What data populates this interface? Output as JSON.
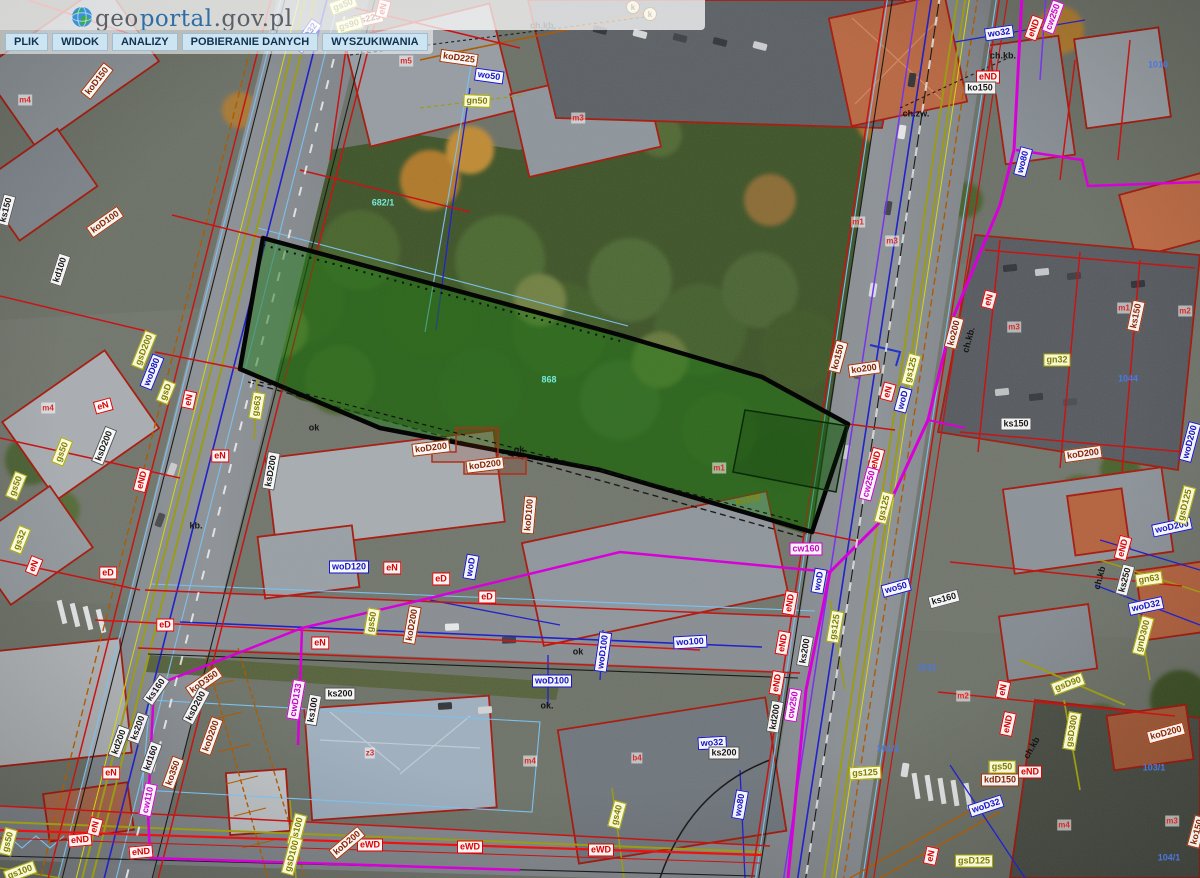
{
  "app": {
    "site": "geoportal.gov.pl"
  },
  "header": {
    "logo": {
      "geo": "geo",
      "portal": "portal",
      "suffix": ".gov.pl"
    },
    "menu": [
      {
        "label": "PLIK"
      },
      {
        "label": "WIDOK"
      },
      {
        "label": "ANALIZY"
      },
      {
        "label": "POBIERANIE DANYCH"
      },
      {
        "label": "WYSZUKIWANIA"
      }
    ]
  },
  "map": {
    "highlighted_parcel": {
      "number": "868",
      "fill": "#1e7a14",
      "outline": "#000000"
    },
    "utility_legend": {
      "ko_kd_sewer_labels": "#8a2500",
      "ks_sewer_labels": "#1a1a1a",
      "wo_water_labels": "#1515cc",
      "gs_gn_gas_labels": "#7e7e00",
      "e_power_labels": "#e00000",
      "cw_heat_labels": "#cc00cc",
      "parcel_lines": "#c81414",
      "telecom_lines": "#b05a00"
    },
    "labels": [
      {
        "s": "gs50",
        "t": "gs",
        "x": 343,
        "y": 5,
        "r": -20
      },
      {
        "s": "ks225",
        "t": "ko",
        "x": 368,
        "y": 19,
        "r": -12
      },
      {
        "s": "gs90",
        "t": "gs",
        "x": 349,
        "y": 25,
        "r": -15
      },
      {
        "s": "eN",
        "t": "e",
        "x": 383,
        "y": 9,
        "r": -75
      },
      {
        "s": "woD32",
        "t": "wo",
        "x": 307,
        "y": 36,
        "r": -55
      },
      {
        "s": "koD150",
        "t": "ko",
        "x": 97,
        "y": 81,
        "r": -52
      },
      {
        "s": "m4",
        "t": "m",
        "x": 25,
        "y": 100,
        "r": 0
      },
      {
        "s": "ks150",
        "t": "ks",
        "x": 6,
        "y": 210,
        "r": -75
      },
      {
        "s": "koD100",
        "t": "ko",
        "x": 105,
        "y": 222,
        "r": -35
      },
      {
        "s": "kd100",
        "t": "ks",
        "x": 60,
        "y": 270,
        "r": -72
      },
      {
        "s": "m5",
        "t": "m",
        "x": 406,
        "y": 61,
        "r": 0
      },
      {
        "s": "koD225",
        "t": "ko",
        "x": 459,
        "y": 58,
        "r": 8
      },
      {
        "s": "wo50",
        "t": "wo",
        "x": 489,
        "y": 76,
        "r": 8
      },
      {
        "s": "gn50",
        "t": "gs",
        "x": 477,
        "y": 101,
        "r": 2
      },
      {
        "s": "ch.kb.",
        "t": "plain",
        "x": 543,
        "y": 26,
        "r": 0
      },
      {
        "s": "m3",
        "t": "m",
        "x": 578,
        "y": 118,
        "r": 0
      },
      {
        "s": "k",
        "t": "kcirc",
        "x": 633,
        "y": 7,
        "r": 0
      },
      {
        "s": "k",
        "t": "kcirc",
        "x": 650,
        "y": 14,
        "r": 0
      },
      {
        "s": "682/1",
        "t": "cyan",
        "x": 383,
        "y": 203,
        "r": 0
      },
      {
        "s": "wo32",
        "t": "wo",
        "x": 999,
        "y": 33,
        "r": -8
      },
      {
        "s": "eND",
        "t": "e",
        "x": 1034,
        "y": 28,
        "r": -70
      },
      {
        "s": "cw250",
        "t": "cw",
        "x": 1053,
        "y": 17,
        "r": -70
      },
      {
        "s": "ch.kb.",
        "t": "plain",
        "x": 1003,
        "y": 56,
        "r": 0
      },
      {
        "s": "eND",
        "t": "e",
        "x": 988,
        "y": 77,
        "r": 0
      },
      {
        "s": "ko150",
        "t": "ks",
        "x": 980,
        "y": 88,
        "r": 0
      },
      {
        "s": "ch.zw.",
        "t": "plain",
        "x": 916,
        "y": 114,
        "r": 0
      },
      {
        "s": "wo80",
        "t": "wo",
        "x": 1023,
        "y": 162,
        "r": -75
      },
      {
        "s": "1010",
        "t": "num",
        "x": 1158,
        "y": 65,
        "r": 0
      },
      {
        "s": "m1",
        "t": "m",
        "x": 858,
        "y": 222,
        "r": 0
      },
      {
        "s": "m3",
        "t": "m",
        "x": 892,
        "y": 241,
        "r": 0
      },
      {
        "s": "m1",
        "t": "m",
        "x": 1124,
        "y": 308,
        "r": 0
      },
      {
        "s": "m2",
        "t": "m",
        "x": 1185,
        "y": 311,
        "r": 0
      },
      {
        "s": "ks150",
        "t": "ko",
        "x": 1136,
        "y": 316,
        "r": -78
      },
      {
        "s": "gsD200",
        "t": "gs",
        "x": 144,
        "y": 350,
        "r": -68
      },
      {
        "s": "woD80",
        "t": "wo",
        "x": 152,
        "y": 372,
        "r": -68
      },
      {
        "s": "gsD",
        "t": "gs",
        "x": 166,
        "y": 392,
        "r": -68
      },
      {
        "s": "eN",
        "t": "e",
        "x": 103,
        "y": 406,
        "r": -15
      },
      {
        "s": "eN",
        "t": "e",
        "x": 189,
        "y": 400,
        "r": -78
      },
      {
        "s": "m4",
        "t": "m",
        "x": 48,
        "y": 408,
        "r": 0
      },
      {
        "s": "ksD200",
        "t": "ks",
        "x": 104,
        "y": 446,
        "r": -68
      },
      {
        "s": "gs50",
        "t": "gs",
        "x": 62,
        "y": 452,
        "r": -68
      },
      {
        "s": "gs63",
        "t": "gs",
        "x": 257,
        "y": 406,
        "r": -80
      },
      {
        "s": "eND",
        "t": "e",
        "x": 142,
        "y": 480,
        "r": -75
      },
      {
        "s": "eN",
        "t": "e",
        "x": 220,
        "y": 456,
        "r": 0
      },
      {
        "s": "ksD200",
        "t": "ks",
        "x": 271,
        "y": 471,
        "r": -80
      },
      {
        "s": "gs50",
        "t": "gs",
        "x": 16,
        "y": 486,
        "r": -68
      },
      {
        "s": "gs32",
        "t": "gs",
        "x": 20,
        "y": 540,
        "r": -68
      },
      {
        "s": "eN",
        "t": "e",
        "x": 34,
        "y": 566,
        "r": -68
      },
      {
        "s": "eD",
        "t": "e",
        "x": 108,
        "y": 573,
        "r": 0
      },
      {
        "s": "kb.",
        "t": "plain",
        "x": 196,
        "y": 526,
        "r": 0
      },
      {
        "s": "ok",
        "t": "plain",
        "x": 314,
        "y": 428,
        "r": 0
      },
      {
        "s": "868",
        "t": "cyan",
        "x": 549,
        "y": 380,
        "r": 0
      },
      {
        "s": "ko250",
        "t": "gs2",
        "x": 748,
        "y": 500,
        "r": -12
      },
      {
        "s": "m1",
        "t": "m",
        "x": 719,
        "y": 468,
        "r": 0
      },
      {
        "s": "koD200",
        "t": "ko",
        "x": 431,
        "y": 448,
        "r": -7
      },
      {
        "s": "koD200",
        "t": "ko",
        "x": 485,
        "y": 465,
        "r": -7
      },
      {
        "s": "ok",
        "t": "plain",
        "x": 519,
        "y": 450,
        "r": 0
      },
      {
        "s": "koD100",
        "t": "ko",
        "x": 529,
        "y": 515,
        "r": -85
      },
      {
        "s": "ko150",
        "t": "ko",
        "x": 838,
        "y": 357,
        "r": -75
      },
      {
        "s": "ko200",
        "t": "ko",
        "x": 864,
        "y": 369,
        "r": -8
      },
      {
        "s": "eN",
        "t": "e",
        "x": 888,
        "y": 392,
        "r": -75
      },
      {
        "s": "eND",
        "t": "e",
        "x": 876,
        "y": 460,
        "r": -75
      },
      {
        "s": "cw250",
        "t": "cw",
        "x": 869,
        "y": 484,
        "r": -75
      },
      {
        "s": "gs125",
        "t": "gs",
        "x": 884,
        "y": 508,
        "r": -75
      },
      {
        "s": "ko200",
        "t": "ko",
        "x": 954,
        "y": 333,
        "r": -75
      },
      {
        "s": "ch.kb.",
        "t": "plain",
        "x": 969,
        "y": 340,
        "r": -75
      },
      {
        "s": "gs125",
        "t": "gs",
        "x": 911,
        "y": 370,
        "r": -75
      },
      {
        "s": "woD",
        "t": "wo",
        "x": 903,
        "y": 400,
        "r": -75
      },
      {
        "s": "eN",
        "t": "e",
        "x": 989,
        "y": 300,
        "r": -75
      },
      {
        "s": "gn32",
        "t": "gs",
        "x": 1057,
        "y": 360,
        "r": 0
      },
      {
        "s": "ks150",
        "t": "ks",
        "x": 1016,
        "y": 424,
        "r": 0
      },
      {
        "s": "koD200",
        "t": "ko",
        "x": 1083,
        "y": 454,
        "r": -8
      },
      {
        "s": "woD200",
        "t": "wo",
        "x": 1190,
        "y": 442,
        "r": -75
      },
      {
        "s": "1044",
        "t": "num",
        "x": 1128,
        "y": 379,
        "r": 0
      },
      {
        "s": "m3",
        "t": "m",
        "x": 1014,
        "y": 327,
        "r": 0
      },
      {
        "s": "woD200",
        "t": "wo",
        "x": 1172,
        "y": 527,
        "r": -12
      },
      {
        "s": "eND",
        "t": "e",
        "x": 1123,
        "y": 548,
        "r": -75
      },
      {
        "s": "ks250",
        "t": "ks",
        "x": 1125,
        "y": 580,
        "r": -75
      },
      {
        "s": "gn63",
        "t": "gs",
        "x": 1149,
        "y": 579,
        "r": -8
      },
      {
        "s": "woD32",
        "t": "wo",
        "x": 1146,
        "y": 606,
        "r": -12
      },
      {
        "s": "gsD125",
        "t": "gs",
        "x": 1185,
        "y": 505,
        "r": -75
      },
      {
        "s": "gnD300",
        "t": "gs",
        "x": 1143,
        "y": 636,
        "r": -75
      },
      {
        "s": "ch.kb",
        "t": "plain",
        "x": 1100,
        "y": 578,
        "r": -75
      },
      {
        "s": "woD120",
        "t": "wo",
        "x": 349,
        "y": 567,
        "r": 0
      },
      {
        "s": "eN",
        "t": "e",
        "x": 392,
        "y": 568,
        "r": 0
      },
      {
        "s": "eD",
        "t": "e",
        "x": 441,
        "y": 579,
        "r": 0
      },
      {
        "s": "woD",
        "t": "wo",
        "x": 471,
        "y": 567,
        "r": -80
      },
      {
        "s": "eD",
        "t": "e",
        "x": 487,
        "y": 597,
        "r": 0
      },
      {
        "s": "gs50",
        "t": "gs",
        "x": 372,
        "y": 622,
        "r": -80
      },
      {
        "s": "koD200",
        "t": "ko",
        "x": 412,
        "y": 625,
        "r": -80
      },
      {
        "s": "eN",
        "t": "e",
        "x": 320,
        "y": 643,
        "r": 0
      },
      {
        "s": "eD",
        "t": "e",
        "x": 165,
        "y": 625,
        "r": 0
      },
      {
        "s": "wo100",
        "t": "wo",
        "x": 690,
        "y": 642,
        "r": -3
      },
      {
        "s": "woD100",
        "t": "wo",
        "x": 603,
        "y": 652,
        "r": -82
      },
      {
        "s": "woD100",
        "t": "wo",
        "x": 552,
        "y": 681,
        "r": 0
      },
      {
        "s": "ok",
        "t": "plain",
        "x": 578,
        "y": 652,
        "r": 0
      },
      {
        "s": "cw160",
        "t": "cw",
        "x": 806,
        "y": 549,
        "r": 0
      },
      {
        "s": "woD",
        "t": "wo",
        "x": 819,
        "y": 581,
        "r": -80
      },
      {
        "s": "wo50",
        "t": "wo",
        "x": 896,
        "y": 588,
        "r": -15
      },
      {
        "s": "ks160",
        "t": "ks",
        "x": 944,
        "y": 599,
        "r": -15
      },
      {
        "s": "eND",
        "t": "e",
        "x": 790,
        "y": 603,
        "r": -80
      },
      {
        "s": "eND",
        "t": "e",
        "x": 783,
        "y": 643,
        "r": -80
      },
      {
        "s": "eND",
        "t": "e",
        "x": 777,
        "y": 683,
        "r": -80
      },
      {
        "s": "ks200",
        "t": "ks",
        "x": 805,
        "y": 651,
        "r": -80
      },
      {
        "s": "gs125",
        "t": "gs",
        "x": 835,
        "y": 627,
        "r": -80
      },
      {
        "s": "cw250",
        "t": "cw",
        "x": 793,
        "y": 705,
        "r": -80
      },
      {
        "s": "kd200",
        "t": "ks",
        "x": 775,
        "y": 717,
        "r": -80
      },
      {
        "s": "wo32",
        "t": "wo",
        "x": 712,
        "y": 743,
        "r": -3
      },
      {
        "s": "ks200",
        "t": "ks",
        "x": 724,
        "y": 753,
        "r": 0
      },
      {
        "s": "wo80",
        "t": "wo",
        "x": 740,
        "y": 805,
        "r": -80
      },
      {
        "s": "gs125",
        "t": "gs",
        "x": 865,
        "y": 773,
        "r": -3
      },
      {
        "s": "101/1",
        "t": "num",
        "x": 888,
        "y": 749,
        "r": 0
      },
      {
        "s": "ks200",
        "t": "ks",
        "x": 340,
        "y": 694,
        "r": 0
      },
      {
        "s": "ks100",
        "t": "ks",
        "x": 313,
        "y": 710,
        "r": -80
      },
      {
        "s": "cwD133",
        "t": "cw",
        "x": 296,
        "y": 700,
        "r": -80
      },
      {
        "s": "koD350",
        "t": "ko",
        "x": 204,
        "y": 682,
        "r": -35
      },
      {
        "s": "ksD200",
        "t": "ks",
        "x": 196,
        "y": 706,
        "r": -62
      },
      {
        "s": "koD200",
        "t": "ko",
        "x": 211,
        "y": 736,
        "r": -70
      },
      {
        "s": "ko350",
        "t": "ko",
        "x": 173,
        "y": 773,
        "r": -70
      },
      {
        "s": "ks200",
        "t": "ks",
        "x": 138,
        "y": 728,
        "r": -70
      },
      {
        "s": "kd200",
        "t": "ks",
        "x": 119,
        "y": 742,
        "r": -70
      },
      {
        "s": "kd160",
        "t": "ks",
        "x": 151,
        "y": 758,
        "r": -70
      },
      {
        "s": "ks160",
        "t": "ks",
        "x": 156,
        "y": 690,
        "r": -55
      },
      {
        "s": "cw110",
        "t": "cw",
        "x": 148,
        "y": 800,
        "r": -78
      },
      {
        "s": "eN",
        "t": "e",
        "x": 111,
        "y": 773,
        "r": 0
      },
      {
        "s": "z3",
        "t": "m",
        "x": 370,
        "y": 753,
        "r": 0
      },
      {
        "s": "m4",
        "t": "m",
        "x": 530,
        "y": 761,
        "r": 0
      },
      {
        "s": "b4",
        "t": "m",
        "x": 637,
        "y": 758,
        "r": 0
      },
      {
        "s": "ok.",
        "t": "plain",
        "x": 547,
        "y": 706,
        "r": 0
      },
      {
        "s": "eND",
        "t": "e",
        "x": 80,
        "y": 840,
        "r": -5
      },
      {
        "s": "eN",
        "t": "e",
        "x": 95,
        "y": 827,
        "r": -75
      },
      {
        "s": "eND",
        "t": "e",
        "x": 141,
        "y": 852,
        "r": -5
      },
      {
        "s": "eWD",
        "t": "e",
        "x": 370,
        "y": 845,
        "r": 0
      },
      {
        "s": "eWD",
        "t": "e",
        "x": 470,
        "y": 847,
        "r": 0
      },
      {
        "s": "eWD",
        "t": "e",
        "x": 601,
        "y": 850,
        "r": 0
      },
      {
        "s": "koD200",
        "t": "ko",
        "x": 347,
        "y": 843,
        "r": -40
      },
      {
        "s": "gs100",
        "t": "gs",
        "x": 297,
        "y": 830,
        "r": -75
      },
      {
        "s": "gsD100",
        "t": "gs",
        "x": 292,
        "y": 856,
        "r": -75
      },
      {
        "s": "gs50",
        "t": "gs",
        "x": 8,
        "y": 842,
        "r": -75
      },
      {
        "s": "gs100",
        "t": "gs",
        "x": 20,
        "y": 872,
        "r": -20
      },
      {
        "s": "gs40",
        "t": "gs",
        "x": 617,
        "y": 815,
        "r": -75
      },
      {
        "s": "eN",
        "t": "e",
        "x": 1003,
        "y": 690,
        "r": -78
      },
      {
        "s": "eND",
        "t": "e",
        "x": 1008,
        "y": 724,
        "r": -78
      },
      {
        "s": "gsD90",
        "t": "gs",
        "x": 1068,
        "y": 684,
        "r": -20
      },
      {
        "s": "gsD300",
        "t": "gs",
        "x": 1072,
        "y": 731,
        "r": -80
      },
      {
        "s": "koD200",
        "t": "ko",
        "x": 1166,
        "y": 733,
        "r": -15
      },
      {
        "s": "gs50",
        "t": "gs",
        "x": 1002,
        "y": 767,
        "r": 0
      },
      {
        "s": "eND",
        "t": "e",
        "x": 1030,
        "y": 772,
        "r": 0
      },
      {
        "s": "kdD150",
        "t": "ko",
        "x": 1000,
        "y": 780,
        "r": 0
      },
      {
        "s": "woD32",
        "t": "wo",
        "x": 986,
        "y": 806,
        "r": -18
      },
      {
        "s": "gsD125",
        "t": "gs",
        "x": 974,
        "y": 861,
        "r": 0
      },
      {
        "s": "eN",
        "t": "e",
        "x": 931,
        "y": 856,
        "r": -78
      },
      {
        "s": "ch.kb",
        "t": "plain",
        "x": 1032,
        "y": 748,
        "r": -60
      },
      {
        "s": "1011",
        "t": "num",
        "x": 927,
        "y": 668,
        "r": 0
      },
      {
        "s": "m2",
        "t": "m",
        "x": 963,
        "y": 696,
        "r": 0
      },
      {
        "s": "m4",
        "t": "m",
        "x": 1064,
        "y": 825,
        "r": 0
      },
      {
        "s": "m3",
        "t": "m",
        "x": 1172,
        "y": 821,
        "r": 0
      },
      {
        "s": "103/1",
        "t": "num",
        "x": 1154,
        "y": 768,
        "r": 0
      },
      {
        "s": "104/1",
        "t": "num",
        "x": 1169,
        "y": 858,
        "r": 0
      },
      {
        "s": "ko150",
        "t": "ko",
        "x": 1197,
        "y": 832,
        "r": -75
      }
    ]
  }
}
